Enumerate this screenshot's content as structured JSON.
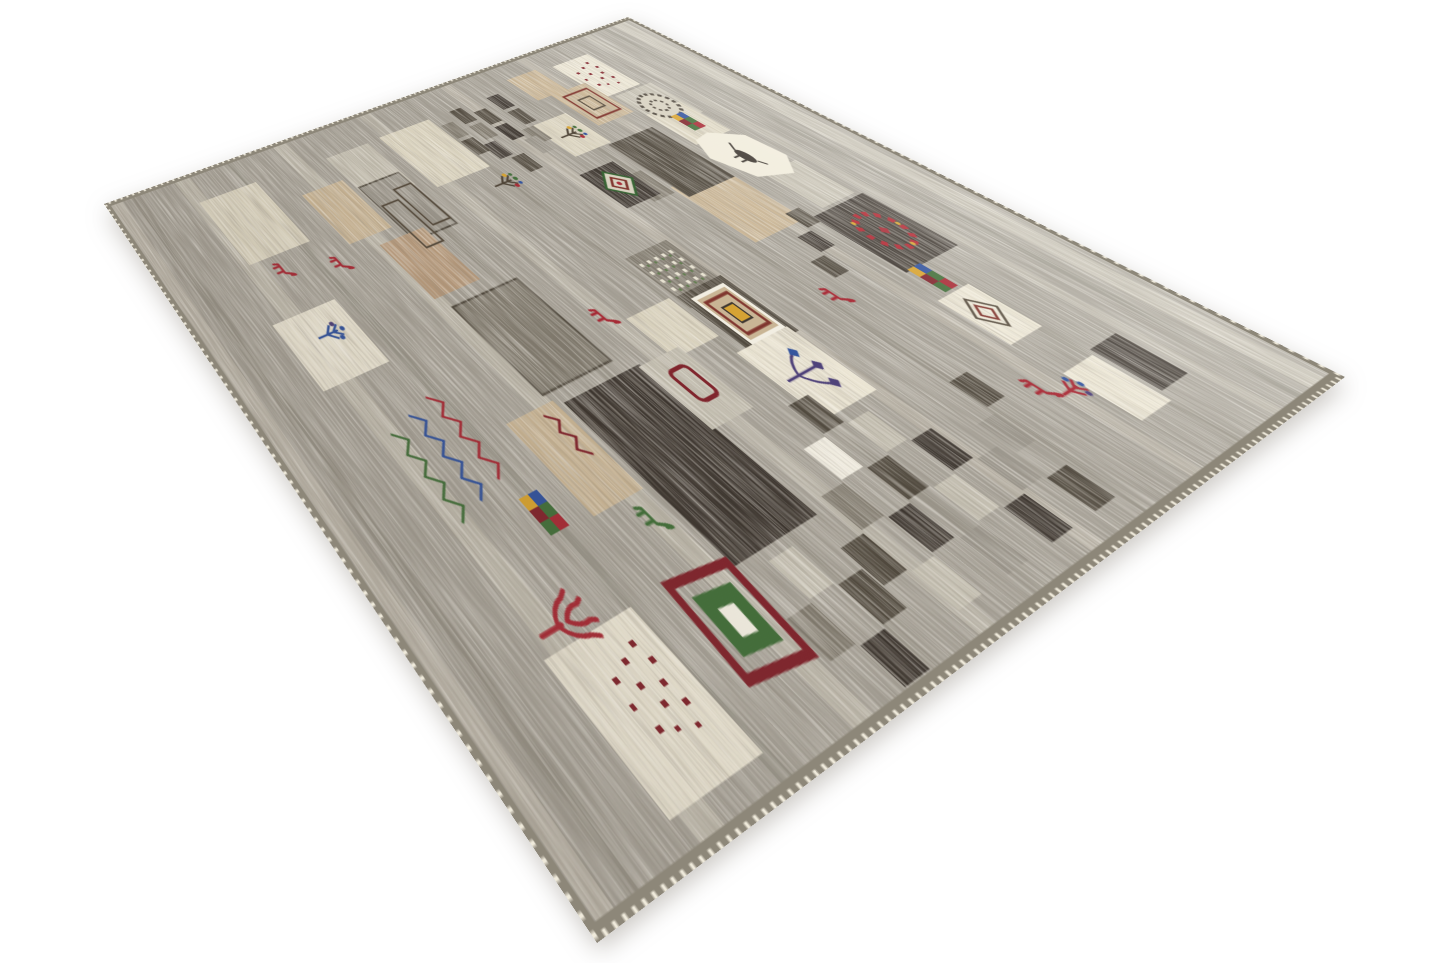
{
  "scene": {
    "type": "product-photograph",
    "subject": "hand-knotted modern Gabbeh patchwork wool rug viewed in perspective from a corner",
    "background_color": "#ffffff",
    "shadow_color": "rgba(100,92,80,0.33)"
  },
  "rug": {
    "style": "gray field with patchwork squares and tribal motifs (goats, trees, diamond medallions, checkerboards, dotted patches)",
    "corners_px": {
      "top": [
        628,
        17
      ],
      "right": [
        1345,
        377
      ],
      "bottom": [
        597,
        943
      ],
      "left": [
        104,
        204
      ]
    },
    "flat_size": {
      "width": 700,
      "height": 980
    },
    "palette": {
      "base": "#a5a096",
      "edge": "#8d8779",
      "selvedge": "#efeadb",
      "streak_light": "#ded8c8",
      "streak_dark": "#6e675b",
      "iv": "#ece6d4",
      "cr": "#ddd6c1",
      "sa": "#c9b493",
      "tn": "#b7997a",
      "lg": "#c4bfb1",
      "mg": "#99948a",
      "dg": "#7e786c",
      "ch": "#4b4439",
      "es": "#37302a",
      "wh": "#f4f0e4",
      "ma": "#7e1f28",
      "gr": "#3e6c36",
      "bl": "#2d4f9c",
      "ye": "#d7a12c",
      "rd": "#a62531",
      "pu": "#473a76"
    },
    "streaks": [
      {
        "y": 18,
        "h": 26,
        "c": "streak_light",
        "o": 0.5
      },
      {
        "y": 58,
        "h": 10,
        "c": "streak_dark",
        "o": 0.22
      },
      {
        "y": 96,
        "h": 14,
        "c": "streak_light",
        "o": 0.35
      },
      {
        "y": 168,
        "h": 10,
        "c": "streak_dark",
        "o": 0.18
      },
      {
        "y": 236,
        "h": 16,
        "c": "streak_light",
        "o": 0.3
      },
      {
        "y": 318,
        "h": 10,
        "c": "streak_dark",
        "o": 0.2
      },
      {
        "y": 388,
        "h": 18,
        "c": "streak_light",
        "o": 0.32
      },
      {
        "y": 470,
        "h": 10,
        "c": "streak_dark",
        "o": 0.2
      },
      {
        "y": 540,
        "h": 20,
        "c": "streak_light",
        "o": 0.38
      },
      {
        "y": 610,
        "h": 10,
        "c": "streak_dark",
        "o": 0.2
      },
      {
        "y": 690,
        "h": 22,
        "c": "streak_light",
        "o": 0.42
      },
      {
        "y": 780,
        "h": 12,
        "c": "streak_dark",
        "o": 0.22
      },
      {
        "y": 850,
        "h": 24,
        "c": "streak_light",
        "o": 0.45
      },
      {
        "y": 930,
        "h": 12,
        "c": "streak_dark",
        "o": 0.25
      },
      {
        "y": 956,
        "h": 16,
        "c": "streak_light",
        "o": 0.4
      }
    ],
    "patches": [
      [
        42,
        146,
        84,
        74,
        "iv"
      ],
      [
        36,
        248,
        54,
        58,
        "sa"
      ],
      [
        90,
        212,
        74,
        68,
        "sa"
      ],
      [
        130,
        130,
        74,
        74,
        "lg"
      ],
      [
        176,
        136,
        68,
        68,
        "cr"
      ],
      [
        314,
        124,
        64,
        60,
        "lg"
      ],
      [
        382,
        116,
        90,
        94,
        "es"
      ],
      [
        282,
        220,
        98,
        88,
        "sa"
      ],
      [
        196,
        220,
        106,
        84,
        "ch"
      ],
      [
        246,
        312,
        44,
        36,
        "dg"
      ],
      [
        126,
        296,
        68,
        66,
        "cr"
      ],
      [
        220,
        328,
        64,
        60,
        "es"
      ],
      [
        336,
        394,
        74,
        68,
        "dg"
      ],
      [
        394,
        390,
        78,
        70,
        "ch"
      ],
      [
        464,
        396,
        78,
        78,
        "iv"
      ],
      [
        506,
        170,
        58,
        54,
        "iv"
      ],
      [
        596,
        118,
        48,
        46,
        "es"
      ],
      [
        600,
        170,
        52,
        50,
        "iv"
      ],
      [
        54,
        476,
        106,
        90,
        "cr"
      ],
      [
        56,
        588,
        88,
        72,
        "lg"
      ],
      [
        118,
        592,
        98,
        66,
        "mg",
        "ch"
      ],
      [
        98,
        668,
        90,
        66,
        "sa"
      ],
      [
        204,
        634,
        86,
        68,
        "tn"
      ],
      [
        306,
        596,
        114,
        96,
        "dg",
        "ch"
      ],
      [
        434,
        574,
        158,
        106,
        "es"
      ],
      [
        428,
        688,
        92,
        62,
        "sa"
      ],
      [
        392,
        470,
        52,
        66,
        "cr"
      ],
      [
        436,
        520,
        72,
        58,
        "lg"
      ],
      [
        52,
        774,
        112,
        90,
        "cr"
      ],
      [
        244,
        804,
        86,
        86,
        "iv"
      ],
      [
        580,
        786,
        98,
        96,
        "iv"
      ],
      [
        366,
        208,
        24,
        24,
        "ch"
      ],
      [
        394,
        234,
        24,
        24,
        "es"
      ],
      [
        422,
        260,
        24,
        24,
        "ch"
      ],
      [
        564,
        298,
        28,
        28,
        "ch"
      ],
      [
        598,
        328,
        28,
        28,
        "mg"
      ],
      [
        54,
        344,
        30,
        22,
        "es"
      ],
      [
        90,
        344,
        30,
        22,
        "ch"
      ],
      [
        126,
        358,
        30,
        22,
        "dg"
      ],
      [
        70,
        386,
        30,
        22,
        "ch"
      ],
      [
        106,
        386,
        30,
        22,
        "es"
      ],
      [
        142,
        372,
        30,
        22,
        "mg"
      ],
      [
        54,
        416,
        30,
        22,
        "ch"
      ],
      [
        90,
        416,
        30,
        22,
        "dg"
      ],
      [
        126,
        430,
        30,
        22,
        "es"
      ],
      [
        160,
        416,
        30,
        22,
        "ch"
      ],
      [
        72,
        450,
        30,
        22,
        "dg"
      ],
      [
        108,
        450,
        30,
        22,
        "ch"
      ],
      [
        520,
        460,
        30,
        30,
        "ch"
      ],
      [
        552,
        428,
        30,
        30,
        "lg"
      ],
      [
        584,
        396,
        30,
        30,
        "es"
      ],
      [
        616,
        364,
        30,
        30,
        "mg"
      ],
      [
        648,
        332,
        30,
        30,
        "ch"
      ],
      [
        552,
        492,
        30,
        30,
        "wh"
      ],
      [
        584,
        460,
        30,
        30,
        "ch"
      ],
      [
        616,
        428,
        30,
        30,
        "lg"
      ],
      [
        648,
        396,
        30,
        30,
        "es"
      ],
      [
        584,
        524,
        30,
        30,
        "dg"
      ],
      [
        616,
        492,
        30,
        30,
        "es"
      ],
      [
        648,
        460,
        30,
        30,
        "mg"
      ],
      [
        616,
        556,
        30,
        30,
        "ch"
      ],
      [
        648,
        524,
        30,
        30,
        "lg"
      ],
      [
        600,
        620,
        30,
        30,
        "lg"
      ],
      [
        632,
        588,
        30,
        30,
        "ch"
      ],
      [
        632,
        652,
        30,
        30,
        "dg"
      ],
      [
        664,
        620,
        28,
        30,
        "es"
      ]
    ],
    "motifs": [
      {
        "t": "dots12",
        "x": 54,
        "y": 158,
        "c": "ma"
      },
      {
        "t": "sqmed",
        "x": 100,
        "y": 222
      },
      {
        "t": "cloud",
        "x": 140,
        "y": 140
      },
      {
        "t": "minigrid",
        "x": 192,
        "y": 156
      },
      {
        "t": "hexbird",
        "x": 226,
        "y": 124
      },
      {
        "t": "wreath",
        "x": 396,
        "y": 128
      },
      {
        "t": "tree1",
        "x": 142,
        "y": 302
      },
      {
        "t": "dmed-green",
        "x": 228,
        "y": 334
      },
      {
        "t": "dotgrid",
        "x": 342,
        "y": 398
      },
      {
        "t": "dmed-ornate",
        "x": 404,
        "y": 400
      },
      {
        "t": "flower3",
        "x": 478,
        "y": 408
      },
      {
        "t": "goat",
        "x": 448,
        "y": 298,
        "c": "rd"
      },
      {
        "t": "goat",
        "x": 368,
        "y": 544,
        "c": "rd"
      },
      {
        "t": "rectlines",
        "x": 140,
        "y": 592
      },
      {
        "t": "tree1",
        "x": 172,
        "y": 456
      },
      {
        "t": "goat",
        "x": 194,
        "y": 752,
        "c": "rd"
      },
      {
        "t": "goat",
        "x": 174,
        "y": 820,
        "c": "rd"
      },
      {
        "t": "tree-blue",
        "x": 262,
        "y": 814
      },
      {
        "t": "zigzag",
        "x": 376,
        "y": 788,
        "c": "rd"
      },
      {
        "t": "zigzag",
        "x": 384,
        "y": 818,
        "c": "bl"
      },
      {
        "t": "zigzag",
        "x": 392,
        "y": 848,
        "c": "gr"
      },
      {
        "t": "minigrid",
        "x": 484,
        "y": 776
      },
      {
        "t": "goat",
        "x": 528,
        "y": 694,
        "c": "gr"
      },
      {
        "t": "coral",
        "x": 546,
        "y": 818,
        "c": "rd"
      },
      {
        "t": "dots12",
        "x": 594,
        "y": 800,
        "c": "ma"
      },
      {
        "t": "gatebox",
        "x": 584,
        "y": 686
      },
      {
        "t": "insq",
        "x": 514,
        "y": 178
      },
      {
        "t": "minigrid",
        "x": 470,
        "y": 182
      },
      {
        "t": "tree-redblue",
        "x": 598,
        "y": 214
      },
      {
        "t": "goat",
        "x": 588,
        "y": 248,
        "c": "rd"
      },
      {
        "t": "ring-rect",
        "x": 452,
        "y": 534,
        "c": "ma"
      },
      {
        "t": "zigzag-sm",
        "x": 436,
        "y": 700,
        "c": "ma"
      }
    ]
  }
}
